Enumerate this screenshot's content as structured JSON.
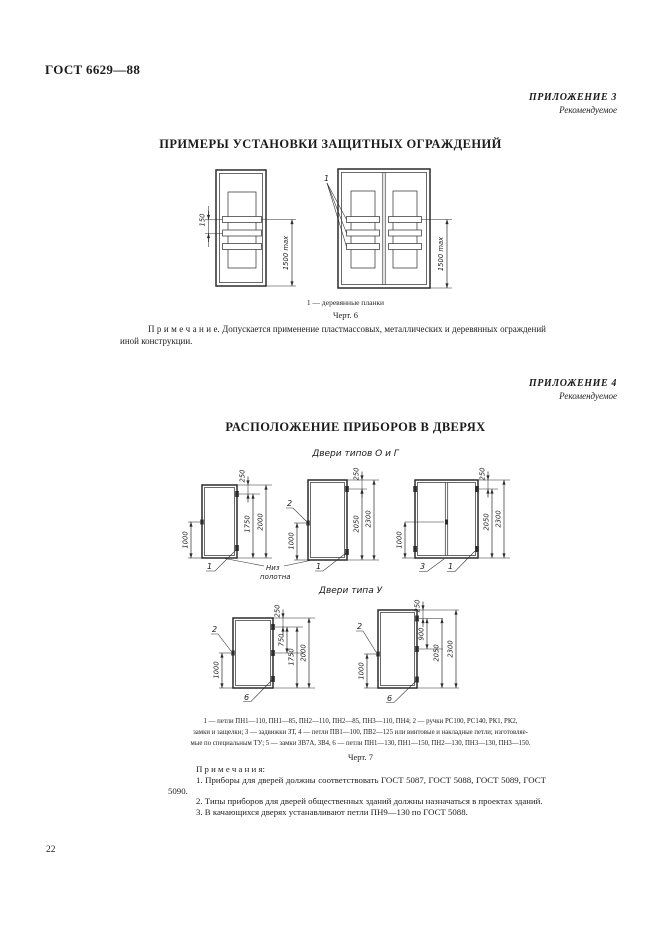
{
  "page": {
    "doc_number": "ГОСТ 6629—88",
    "number": "22"
  },
  "appendix3": {
    "label": "ПРИЛОЖЕНИЕ 3",
    "sublabel": "Рекомендуемое",
    "title": "ПРИМЕРЫ УСТАНОВКИ ЗАЩИТНЫХ ОГРАЖДЕНИЙ",
    "fig6": {
      "callout": "1",
      "dim_spacing": "150",
      "dim_height_left": "1500 max",
      "dim_height_right": "1500 max",
      "caption": "1 — деревянные планки",
      "figure_label": "Черт. 6"
    },
    "note": "П р и м е ч а н и е.  Допускается применение пластмассовых, металлических и деревянных ограждений иной конструкции."
  },
  "appendix4": {
    "label": "ПРИЛОЖЕНИЕ 4",
    "sublabel": "Рекомендуемое",
    "title": "РАСПОЛОЖЕНИЕ ПРИБОРОВ В ДВЕРЯХ",
    "group1_title": "Двери типов О и Г",
    "group2_title": "Двери типа У",
    "bottom_label_line1": "Низ",
    "bottom_label_line2": "полотна",
    "doors": {
      "a": {
        "dim_top": "250",
        "dim_hinge": "1750",
        "dim_full": "2000",
        "dim_handle": "1000",
        "label_hinge": "1"
      },
      "b": {
        "dim_top": "250",
        "dim_hinge": "2050",
        "dim_full": "2300",
        "dim_handle": "1000",
        "label_handle": "2",
        "label_hinge": "1"
      },
      "c": {
        "dim_top": "250",
        "dim_hinge": "2050",
        "dim_full": "2300",
        "dim_handle": "1000",
        "label_latch": "3",
        "label_hinge": "1"
      },
      "d": {
        "dim_top": "250",
        "dim_mid": "750",
        "dim_hinge": "1750",
        "dim_full": "2000",
        "dim_handle": "1000",
        "label_handle": "2",
        "label_hinge": "6"
      },
      "e": {
        "dim_top": "250",
        "dim_mid": "900",
        "dim_hinge": "2050",
        "dim_full": "2300",
        "dim_handle": "1000",
        "label_handle": "2",
        "label_hinge": "6"
      }
    },
    "legend_lines": [
      "1 — петли ПН1—110, ПН1—85, ПН2—110, ПН2—85, ПН3—110, ПН4; 2 — ручки РС100, РС140, РК1, РК2,",
      "замки и защелки; 3 — задвижки ЗТ, 4 — петли ПВ1—100, ПВ2—125 или винтовые и накладные петли; изготовляе-",
      "мые по специальным ТУ; 5 — замки ЗВ7А, ЗВ4, 6 — петли ПН1—130, ПН1—150, ПН2—130, ПН3—130, ПН3—150."
    ],
    "figure_label": "Черт. 7",
    "notes_title": "П р и м е ч а н и я:",
    "notes": [
      "1. Приборы для дверей должны соответствовать ГОСТ 5087, ГОСТ 5088, ГОСТ 5089, ГОСТ 5090.",
      "2. Типы приборов для дверей общественных зданий должны назначаться в проектах зданий.",
      "3. В качающихся дверях устанавливают петли ПН9—130 по ГОСТ 5088."
    ]
  }
}
